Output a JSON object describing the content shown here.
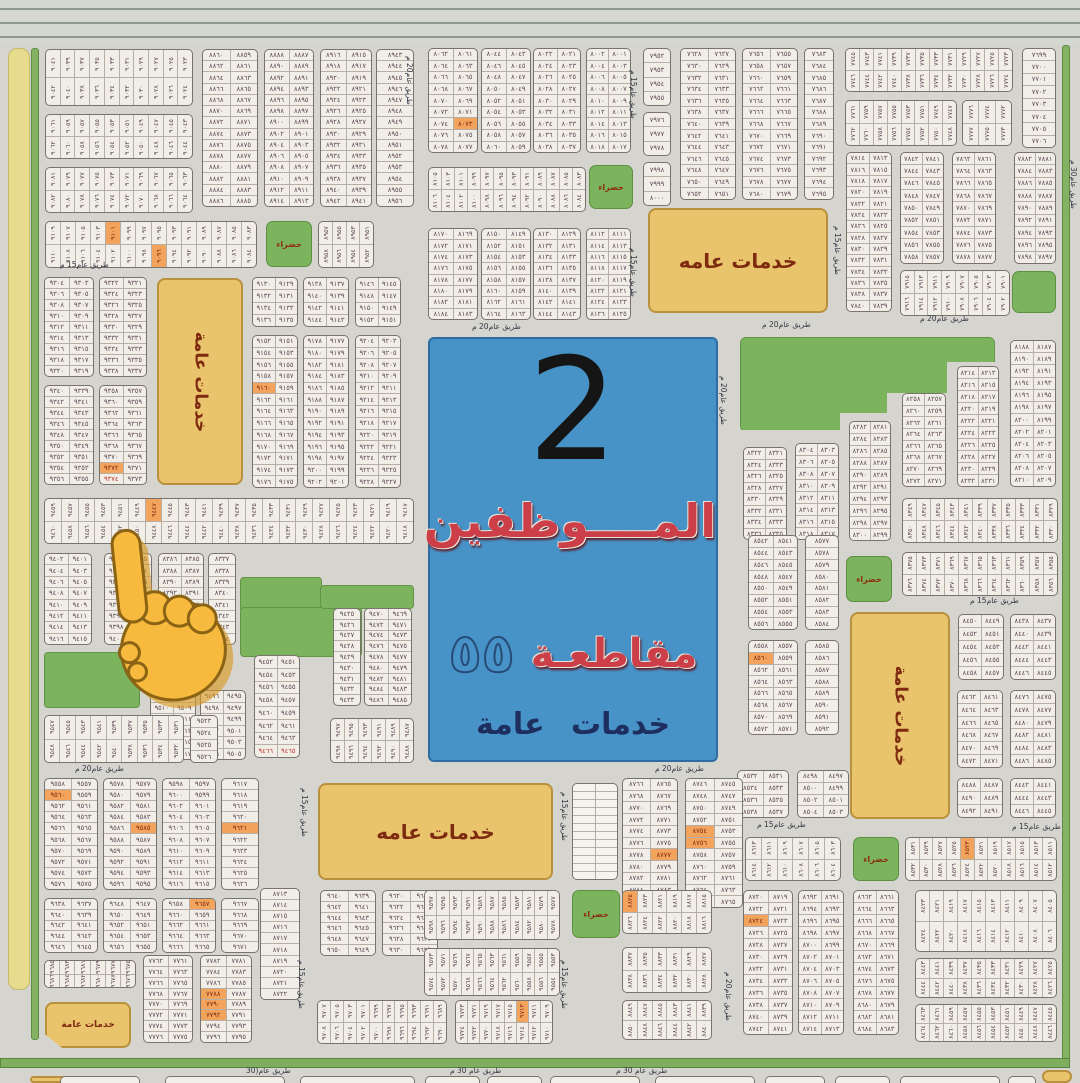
{
  "palette": {
    "background": "#d6d4ce",
    "block_fill": "#f1eee8",
    "block_border": "#78736d",
    "number_color": "#5d4853",
    "highlight_orange": "#f2a35c",
    "highlight_red_text": "#c23a2c",
    "service_fill": "#eac46c",
    "service_border": "#b9913d",
    "service_text": "#7e2a10",
    "green_fill": "#7cb45d",
    "blue_box": "#4792c7",
    "title_red": "#cd3f48",
    "title_navy": "#1d2e5f",
    "yellow_strip": "#e7db8d",
    "road_green": "#7fae5f",
    "hand_yellow": "#f8ba3e"
  },
  "blue_box": {
    "number": "2",
    "line1": "المــــوظفين",
    "line2_word": "مقاطعـة",
    "line2_num": "٥٥",
    "line3": "خدمات عامة"
  },
  "service_boxes": [
    {
      "x": 648,
      "y": 208,
      "w": 180,
      "h": 105,
      "label": "خدمات عامه",
      "o": "h",
      "fs": 20
    },
    {
      "x": 157,
      "y": 278,
      "w": 86,
      "h": 207,
      "label": "خدمات عامة",
      "o": "v",
      "fs": 17
    },
    {
      "x": 850,
      "y": 612,
      "w": 100,
      "h": 207,
      "label": "خدمات عامة",
      "o": "v",
      "fs": 17
    },
    {
      "x": 318,
      "y": 783,
      "w": 235,
      "h": 97,
      "label": "خدمات عامه",
      "o": "h",
      "fs": 20
    },
    {
      "x": 45,
      "y": 1002,
      "w": 86,
      "h": 46,
      "label": "خدمات عامة",
      "o": "h",
      "fs": 9,
      "cut": 1
    },
    {
      "x": 30,
      "y": 1076,
      "w": 108,
      "h": 7,
      "label": "",
      "o": "h",
      "fs": 0
    },
    {
      "x": 1042,
      "y": 1070,
      "w": 30,
      "h": 13,
      "label": "",
      "o": "h",
      "fs": 0
    }
  ],
  "green_boxes": [
    {
      "x": 266,
      "y": 221,
      "w": 46,
      "h": 46,
      "label": "خضراء"
    },
    {
      "x": 589,
      "y": 165,
      "w": 44,
      "h": 44,
      "label": "خضراء"
    },
    {
      "x": 846,
      "y": 556,
      "w": 46,
      "h": 46,
      "label": "خضراء"
    },
    {
      "x": 853,
      "y": 837,
      "w": 46,
      "h": 44,
      "label": "خضراء"
    },
    {
      "x": 572,
      "y": 890,
      "w": 48,
      "h": 48,
      "label": "خضراء"
    },
    {
      "x": 1012,
      "y": 271,
      "w": 44,
      "h": 42,
      "label": ""
    }
  ],
  "green_areas": [
    {
      "x": 240,
      "y": 577,
      "w": 80,
      "h": 33
    },
    {
      "x": 240,
      "y": 607,
      "w": 120,
      "h": 48
    },
    {
      "x": 320,
      "y": 585,
      "w": 92,
      "h": 22
    },
    {
      "x": 44,
      "y": 652,
      "w": 94,
      "h": 54
    },
    {
      "x": 740,
      "y": 337,
      "w": 253,
      "h": 93,
      "steps": 1
    }
  ],
  "road_labels": [
    {
      "t": "طريق عام15 م",
      "x": 60,
      "y": 260
    },
    {
      "t": "طريق عام20 م",
      "x": 75,
      "y": 764
    },
    {
      "t": "طريق عام20 م",
      "x": 405,
      "y": 56,
      "v": 1
    },
    {
      "t": "طريق عام15 م",
      "x": 629,
      "y": 70,
      "v": 1
    },
    {
      "t": "طريق عام15 م",
      "x": 629,
      "y": 248,
      "v": 1
    },
    {
      "t": "طريق عام15 م",
      "x": 833,
      "y": 226,
      "v": 1
    },
    {
      "t": "طريق عام20 م",
      "x": 472,
      "y": 322
    },
    {
      "t": "طريق عام20 م",
      "x": 762,
      "y": 320
    },
    {
      "t": "طريق عام20 م",
      "x": 920,
      "y": 314
    },
    {
      "t": "طريق عام30 م",
      "x": 1069,
      "y": 160,
      "v": 1
    },
    {
      "t": "طريق عام20 م",
      "x": 719,
      "y": 376,
      "v": 1
    },
    {
      "t": "طريق عام15 م",
      "x": 970,
      "y": 596
    },
    {
      "t": "طريق عام20 م",
      "x": 655,
      "y": 764
    },
    {
      "t": "طريق عام15 م",
      "x": 300,
      "y": 788,
      "v": 1
    },
    {
      "t": "طريق عام15 م",
      "x": 560,
      "y": 792,
      "v": 1
    },
    {
      "t": "طريق عام15 م",
      "x": 757,
      "y": 820
    },
    {
      "t": "طريق عام15 م",
      "x": 1012,
      "y": 822
    },
    {
      "t": "طريق عام15 م",
      "x": 297,
      "y": 960,
      "v": 1
    },
    {
      "t": "طريق عام15 م",
      "x": 560,
      "y": 960,
      "v": 1
    },
    {
      "t": "طريق عام20 م",
      "x": 724,
      "y": 972,
      "v": 1
    },
    {
      "t": "طريق عام 30 م",
      "x": 450,
      "y": 1066
    },
    {
      "t": "طريق عام 30 م",
      "x": 616,
      "y": 1066
    },
    {
      "t": "طريق عام(30",
      "x": 246,
      "y": 1066
    }
  ],
  "blocks": [
    {
      "x": 45,
      "y": 49,
      "w": 148,
      "h": 57,
      "t": "v",
      "r": 2,
      "c": 10,
      "b": 9023
    },
    {
      "x": 45,
      "y": 114,
      "w": 148,
      "h": 45,
      "t": "v",
      "r": 2,
      "c": 10,
      "b": 9043
    },
    {
      "x": 45,
      "y": 167,
      "w": 148,
      "h": 46,
      "t": "v",
      "r": 2,
      "c": 10,
      "b": 9063
    },
    {
      "x": 45,
      "y": 221,
      "w": 212,
      "h": 47,
      "t": "v",
      "r": 2,
      "c": 14,
      "b": 9083,
      "hl": [
        4,
        21
      ]
    },
    {
      "x": 202,
      "y": 49,
      "w": 56,
      "h": 158,
      "t": "2",
      "r": 14,
      "b": 8859
    },
    {
      "x": 264,
      "y": 49,
      "w": 50,
      "h": 158,
      "t": "2",
      "r": 14,
      "b": 8887
    },
    {
      "x": 320,
      "y": 49,
      "w": 52,
      "h": 158,
      "t": "2",
      "r": 14,
      "b": 8915
    },
    {
      "x": 376,
      "y": 49,
      "w": 38,
      "h": 158,
      "t": "1",
      "r": 14,
      "b": 8943
    },
    {
      "x": 318,
      "y": 221,
      "w": 56,
      "h": 47,
      "t": "v",
      "r": 2,
      "c": 4,
      "b": 8951
    },
    {
      "x": 44,
      "y": 277,
      "w": 50,
      "h": 100,
      "t": "2",
      "r": 9,
      "b": 9303
    },
    {
      "x": 99,
      "y": 277,
      "w": 48,
      "h": 100,
      "t": "2",
      "r": 9,
      "b": 9321
    },
    {
      "x": 44,
      "y": 385,
      "w": 50,
      "h": 100,
      "t": "2",
      "r": 9,
      "b": 9339
    },
    {
      "x": 99,
      "y": 385,
      "w": 48,
      "h": 100,
      "t": "2",
      "r": 9,
      "b": 9357,
      "hl": [
        14
      ],
      "rd": [
        16
      ]
    },
    {
      "x": 252,
      "y": 277,
      "w": 46,
      "h": 50,
      "t": "2",
      "r": 4,
      "b": 9129
    },
    {
      "x": 303,
      "y": 277,
      "w": 46,
      "h": 50,
      "t": "2",
      "r": 4,
      "b": 9137
    },
    {
      "x": 355,
      "y": 277,
      "w": 46,
      "h": 50,
      "t": "2",
      "r": 4,
      "b": 9145
    },
    {
      "x": 252,
      "y": 335,
      "w": 46,
      "h": 153,
      "t": "2",
      "r": 13,
      "b": 9151,
      "hl": [
        8
      ]
    },
    {
      "x": 303,
      "y": 335,
      "w": 46,
      "h": 153,
      "t": "2",
      "r": 13,
      "b": 9177
    },
    {
      "x": 355,
      "y": 335,
      "w": 46,
      "h": 153,
      "t": "2",
      "r": 13,
      "b": 9203
    },
    {
      "x": 44,
      "y": 498,
      "w": 370,
      "h": 46,
      "t": "v",
      "r": 2,
      "c": 22,
      "b": 9417,
      "hl": [
        6
      ]
    },
    {
      "x": 44,
      "y": 553,
      "w": 48,
      "h": 92,
      "t": "2",
      "r": 8,
      "b": 9401
    },
    {
      "x": 104,
      "y": 553,
      "w": 48,
      "h": 92,
      "t": "2",
      "r": 8,
      "b": 9385
    },
    {
      "x": 158,
      "y": 553,
      "w": 46,
      "h": 92,
      "t": "2",
      "r": 8,
      "b": 8385
    },
    {
      "x": 208,
      "y": 553,
      "w": 28,
      "h": 92,
      "t": "1",
      "r": 8,
      "b": 8337
    },
    {
      "x": 150,
      "y": 690,
      "w": 46,
      "h": 70,
      "t": "2",
      "r": 6,
      "b": 9507,
      "hl": [
        10
      ]
    },
    {
      "x": 200,
      "y": 690,
      "w": 46,
      "h": 70,
      "t": "2",
      "r": 6,
      "b": 9495
    },
    {
      "x": 254,
      "y": 655,
      "w": 46,
      "h": 103,
      "t": "2",
      "r": 8,
      "b": 9451,
      "rd": [
        14,
        15
      ]
    },
    {
      "x": 333,
      "y": 608,
      "w": 28,
      "h": 98,
      "t": "1",
      "r": 9,
      "b": 9425
    },
    {
      "x": 364,
      "y": 608,
      "w": 48,
      "h": 98,
      "t": "2",
      "r": 9,
      "b": 9469
    },
    {
      "x": 330,
      "y": 718,
      "w": 84,
      "h": 45,
      "t": "v",
      "r": 2,
      "c": 6,
      "b": 9487
    },
    {
      "x": 44,
      "y": 715,
      "w": 140,
      "h": 48,
      "t": "v",
      "r": 2,
      "c": 9,
      "b": 9531
    },
    {
      "x": 190,
      "y": 715,
      "w": 28,
      "h": 48,
      "t": "1",
      "r": 4,
      "b": 9523
    },
    {
      "x": 44,
      "y": 778,
      "w": 54,
      "h": 112,
      "t": "2",
      "r": 10,
      "b": 9557,
      "hl": [
        2
      ]
    },
    {
      "x": 103,
      "y": 778,
      "w": 54,
      "h": 112,
      "t": "2",
      "r": 10,
      "b": 9577,
      "hl": [
        9
      ]
    },
    {
      "x": 162,
      "y": 778,
      "w": 54,
      "h": 112,
      "t": "2",
      "r": 10,
      "b": 9597
    },
    {
      "x": 221,
      "y": 778,
      "w": 38,
      "h": 112,
      "t": "1",
      "r": 10,
      "b": 9617,
      "hl": [
        4
      ]
    },
    {
      "x": 44,
      "y": 898,
      "w": 54,
      "h": 55,
      "t": "2",
      "r": 5,
      "b": 9637
    },
    {
      "x": 103,
      "y": 898,
      "w": 54,
      "h": 55,
      "t": "2",
      "r": 5,
      "b": 9647
    },
    {
      "x": 162,
      "y": 898,
      "w": 54,
      "h": 55,
      "t": "2",
      "r": 5,
      "b": 9657,
      "hl": [
        1
      ]
    },
    {
      "x": 221,
      "y": 898,
      "w": 38,
      "h": 55,
      "t": "1",
      "r": 5,
      "b": 9667
    },
    {
      "x": 44,
      "y": 960,
      "w": 92,
      "h": 28,
      "t": "v",
      "r": 2,
      "c": 6,
      "b": 9675
    },
    {
      "x": 143,
      "y": 955,
      "w": 50,
      "h": 88,
      "t": "2",
      "r": 8,
      "b": 7761
    },
    {
      "x": 200,
      "y": 955,
      "w": 52,
      "h": 88,
      "t": "2",
      "r": 8,
      "b": 7781,
      "hl": [
        6,
        8,
        10
      ]
    },
    {
      "x": 260,
      "y": 888,
      "w": 40,
      "h": 112,
      "t": "1",
      "r": 10,
      "b": 8713
    },
    {
      "x": 320,
      "y": 890,
      "w": 56,
      "h": 66,
      "t": "2",
      "r": 6,
      "b": 9639
    },
    {
      "x": 382,
      "y": 890,
      "w": 56,
      "h": 66,
      "t": "2",
      "r": 6,
      "b": 9619
    },
    {
      "x": 424,
      "y": 890,
      "w": 136,
      "h": 50,
      "t": "v",
      "r": 2,
      "c": 11,
      "b": 9577
    },
    {
      "x": 424,
      "y": 948,
      "w": 136,
      "h": 48,
      "t": "v",
      "r": 2,
      "c": 11,
      "b": 9553
    },
    {
      "x": 317,
      "y": 1000,
      "w": 130,
      "h": 44,
      "t": "v",
      "r": 2,
      "c": 10,
      "b": 9689
    },
    {
      "x": 455,
      "y": 1000,
      "w": 98,
      "h": 44,
      "t": "v",
      "r": 2,
      "c": 8,
      "b": 9709,
      "hl": [
        5
      ]
    },
    {
      "x": 572,
      "y": 783,
      "w": 46,
      "h": 97,
      "t": "g",
      "r": 12,
      "c": 2
    },
    {
      "x": 428,
      "y": 48,
      "w": 50,
      "h": 105,
      "t": "2",
      "r": 9,
      "b": 8061,
      "hl": [
        13
      ]
    },
    {
      "x": 481,
      "y": 48,
      "w": 50,
      "h": 105,
      "t": "2",
      "r": 9,
      "b": 8043
    },
    {
      "x": 533,
      "y": 48,
      "w": 48,
      "h": 105,
      "t": "2",
      "r": 9,
      "b": 8021
    },
    {
      "x": 586,
      "y": 48,
      "w": 45,
      "h": 105,
      "t": "2",
      "r": 9,
      "b": 8001
    },
    {
      "x": 428,
      "y": 167,
      "w": 158,
      "h": 45,
      "t": "v",
      "r": 2,
      "c": 12,
      "b": 8083
    },
    {
      "x": 428,
      "y": 228,
      "w": 50,
      "h": 92,
      "t": "2",
      "r": 8,
      "b": 8169
    },
    {
      "x": 481,
      "y": 228,
      "w": 50,
      "h": 92,
      "t": "2",
      "r": 8,
      "b": 8149
    },
    {
      "x": 533,
      "y": 228,
      "w": 48,
      "h": 92,
      "t": "2",
      "r": 8,
      "b": 8129
    },
    {
      "x": 586,
      "y": 228,
      "w": 45,
      "h": 92,
      "t": "2",
      "r": 8,
      "b": 8111
    },
    {
      "x": 643,
      "y": 48,
      "w": 28,
      "h": 58,
      "t": "1",
      "r": 4,
      "b": 7952
    },
    {
      "x": 643,
      "y": 112,
      "w": 28,
      "h": 44,
      "t": "1",
      "r": 3,
      "b": 7976
    },
    {
      "x": 643,
      "y": 162,
      "w": 28,
      "h": 44,
      "t": "1",
      "r": 3,
      "b": 7998
    },
    {
      "x": 680,
      "y": 48,
      "w": 56,
      "h": 152,
      "t": "2",
      "r": 13,
      "b": 7627
    },
    {
      "x": 742,
      "y": 48,
      "w": 56,
      "h": 152,
      "t": "2",
      "r": 13,
      "b": 7655
    },
    {
      "x": 804,
      "y": 48,
      "w": 30,
      "h": 152,
      "t": "1",
      "r": 13,
      "b": 7683
    },
    {
      "x": 845,
      "y": 48,
      "w": 168,
      "h": 44,
      "t": "v",
      "r": 2,
      "c": 12,
      "b": 7723
    },
    {
      "x": 845,
      "y": 100,
      "w": 112,
      "h": 46,
      "t": "v",
      "r": 2,
      "c": 8,
      "b": 7747
    },
    {
      "x": 962,
      "y": 100,
      "w": 50,
      "h": 46,
      "t": "v",
      "r": 2,
      "c": 3,
      "b": 7772
    },
    {
      "x": 1022,
      "y": 48,
      "w": 34,
      "h": 100,
      "t": "1",
      "r": 8,
      "b": 7699
    },
    {
      "x": 846,
      "y": 152,
      "w": 46,
      "h": 160,
      "t": "2",
      "r": 14,
      "b": 7813
    },
    {
      "x": 900,
      "y": 152,
      "w": 44,
      "h": 112,
      "t": "2",
      "r": 9,
      "b": 7841
    },
    {
      "x": 952,
      "y": 152,
      "w": 44,
      "h": 112,
      "t": "2",
      "r": 9,
      "b": 7861
    },
    {
      "x": 1014,
      "y": 152,
      "w": 42,
      "h": 112,
      "t": "2",
      "r": 9,
      "b": 7881
    },
    {
      "x": 900,
      "y": 270,
      "w": 110,
      "h": 46,
      "t": "v",
      "r": 2,
      "c": 8,
      "b": 7901
    },
    {
      "x": 743,
      "y": 447,
      "w": 44,
      "h": 93,
      "t": "2",
      "r": 8,
      "b": 8321
    },
    {
      "x": 795,
      "y": 443,
      "w": 44,
      "h": 97,
      "t": "2",
      "r": 8,
      "b": 8303
    },
    {
      "x": 849,
      "y": 421,
      "w": 42,
      "h": 120,
      "t": "2",
      "r": 10,
      "b": 8281
    },
    {
      "x": 902,
      "y": 393,
      "w": 44,
      "h": 94,
      "t": "2",
      "r": 8,
      "b": 8257
    },
    {
      "x": 957,
      "y": 366,
      "w": 42,
      "h": 121,
      "t": "2",
      "r": 10,
      "b": 8213
    },
    {
      "x": 1010,
      "y": 340,
      "w": 46,
      "h": 147,
      "t": "2",
      "r": 12,
      "b": 8187
    },
    {
      "x": 902,
      "y": 498,
      "w": 156,
      "h": 45,
      "t": "v",
      "r": 2,
      "c": 11,
      "b": 8329
    },
    {
      "x": 902,
      "y": 552,
      "w": 156,
      "h": 44,
      "t": "v",
      "r": 2,
      "c": 11,
      "b": 8355
    },
    {
      "x": 958,
      "y": 614,
      "w": 46,
      "h": 66,
      "t": "2",
      "r": 5,
      "b": 8449
    },
    {
      "x": 1010,
      "y": 614,
      "w": 46,
      "h": 66,
      "t": "2",
      "r": 5,
      "b": 8437
    },
    {
      "x": 957,
      "y": 690,
      "w": 46,
      "h": 78,
      "t": "2",
      "r": 6,
      "b": 8461
    },
    {
      "x": 1010,
      "y": 690,
      "w": 46,
      "h": 78,
      "t": "2",
      "r": 6,
      "b": 8475
    },
    {
      "x": 957,
      "y": 778,
      "w": 46,
      "h": 40,
      "t": "2",
      "r": 3,
      "b": 8487
    },
    {
      "x": 1010,
      "y": 778,
      "w": 46,
      "h": 40,
      "t": "2",
      "r": 3,
      "b": 8441
    },
    {
      "x": 748,
      "y": 535,
      "w": 50,
      "h": 95,
      "t": "2",
      "r": 8,
      "b": 8541
    },
    {
      "x": 805,
      "y": 535,
      "w": 34,
      "h": 95,
      "t": "1",
      "r": 8,
      "b": 8577
    },
    {
      "x": 748,
      "y": 640,
      "w": 50,
      "h": 95,
      "t": "2",
      "r": 8,
      "b": 8557,
      "hl": [
        2
      ]
    },
    {
      "x": 805,
      "y": 640,
      "w": 34,
      "h": 95,
      "t": "1",
      "r": 8,
      "b": 8585
    },
    {
      "x": 737,
      "y": 770,
      "w": 52,
      "h": 48,
      "t": "2",
      "r": 4,
      "b": 8531
    },
    {
      "x": 797,
      "y": 770,
      "w": 52,
      "h": 48,
      "t": "2",
      "r": 4,
      "b": 8497
    },
    {
      "x": 622,
      "y": 778,
      "w": 56,
      "h": 130,
      "t": "2",
      "r": 11,
      "b": 8765,
      "hl": [
        13
      ]
    },
    {
      "x": 685,
      "y": 778,
      "w": 58,
      "h": 130,
      "t": "2",
      "r": 11,
      "b": 8745,
      "hl": [
        8,
        10
      ]
    },
    {
      "x": 745,
      "y": 837,
      "w": 96,
      "h": 44,
      "t": "v",
      "r": 2,
      "c": 6,
      "b": 8603
    },
    {
      "x": 905,
      "y": 837,
      "w": 152,
      "h": 44,
      "t": "v",
      "r": 2,
      "c": 11,
      "b": 8511,
      "hl": [
        4
      ]
    },
    {
      "x": 622,
      "y": 890,
      "w": 90,
      "h": 44,
      "t": "v",
      "r": 2,
      "c": 6,
      "b": 8815,
      "hl": [
        0
      ]
    },
    {
      "x": 622,
      "y": 947,
      "w": 90,
      "h": 46,
      "t": "v",
      "r": 2,
      "c": 6,
      "b": 8827
    },
    {
      "x": 622,
      "y": 1000,
      "w": 90,
      "h": 40,
      "t": "v",
      "r": 2,
      "c": 6,
      "b": 8839
    },
    {
      "x": 743,
      "y": 890,
      "w": 50,
      "h": 145,
      "t": "2",
      "r": 12,
      "b": 8719,
      "hl": [
        4
      ]
    },
    {
      "x": 798,
      "y": 890,
      "w": 46,
      "h": 145,
      "t": "2",
      "r": 12,
      "b": 8691
    },
    {
      "x": 853,
      "y": 890,
      "w": 46,
      "h": 145,
      "t": "2",
      "r": 12,
      "b": 8661
    },
    {
      "x": 915,
      "y": 890,
      "w": 142,
      "h": 62,
      "t": "v",
      "r": 2,
      "c": 10,
      "b": 8405
    },
    {
      "x": 915,
      "y": 958,
      "w": 142,
      "h": 40,
      "t": "v",
      "r": 2,
      "c": 10,
      "b": 8425
    },
    {
      "x": 915,
      "y": 1004,
      "w": 142,
      "h": 38,
      "t": "v",
      "r": 2,
      "c": 10,
      "b": 8445
    }
  ],
  "stubs": [
    [
      60,
      80
    ],
    [
      165,
      120
    ],
    [
      300,
      115
    ],
    [
      425,
      55
    ],
    [
      487,
      55
    ],
    [
      550,
      90
    ],
    [
      655,
      100
    ],
    [
      765,
      60
    ],
    [
      835,
      55
    ],
    [
      900,
      100
    ],
    [
      1008,
      28
    ]
  ]
}
